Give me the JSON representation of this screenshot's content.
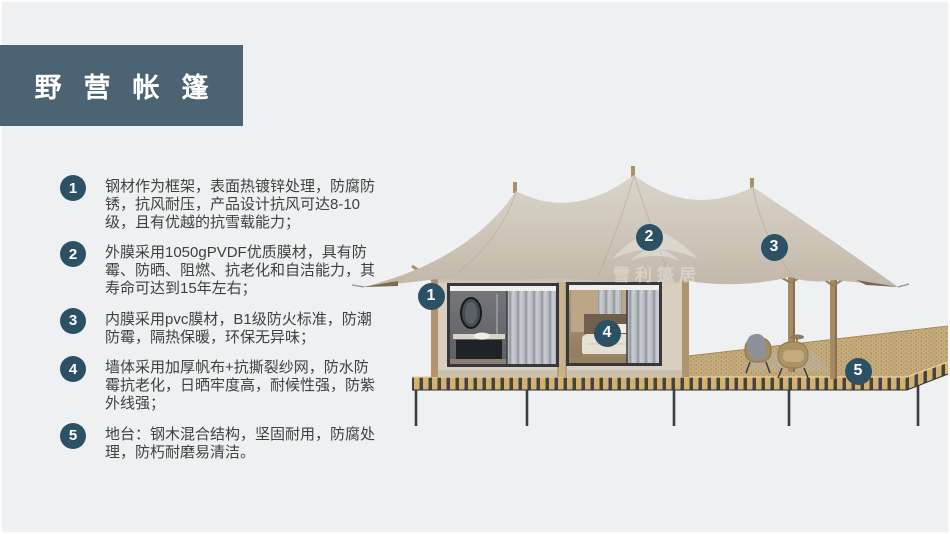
{
  "slide": {
    "title": "野营帐篷",
    "background_color": "#eff0f2",
    "banner_color": "#4c6374",
    "badge_color": "#2d5164",
    "body_text_color": "#3f4040"
  },
  "features": [
    {
      "num": "1",
      "text": "钢材作为框架，表面热镀锌处理，防腐防锈，抗风耐压，产品设计抗风可达8-10级，且有优越的抗雪载能力；"
    },
    {
      "num": "2",
      "text": "外膜采用1050gPVDF优质膜材，具有防霉、防晒、阻燃、抗老化和自洁能力，其寿命可达到15年左右；"
    },
    {
      "num": "3",
      "text": "内膜采用pvc膜材，B1级防火标准，防潮防霉，隔热保暖，环保无异味；"
    },
    {
      "num": "4",
      "text": "墙体采用加厚帆布+抗撕裂纱网，防水防霉抗老化，日晒牢度高，耐候性强，防紫外线强；"
    },
    {
      "num": "5",
      "text": "地台：钢木混合结构，坚固耐用，防腐处理，防朽耐磨易清洁。"
    }
  ],
  "illustration": {
    "watermark": {
      "icon": "tent-roof-icon",
      "text": "雪利篷居"
    },
    "callouts": [
      {
        "num": "1",
        "x": 431,
        "y": 296
      },
      {
        "num": "2",
        "x": 649,
        "y": 237
      },
      {
        "num": "3",
        "x": 774,
        "y": 247
      },
      {
        "num": "4",
        "x": 607,
        "y": 333
      },
      {
        "num": "5",
        "x": 858,
        "y": 371
      }
    ],
    "palette": {
      "canopy": "#ccc4b7",
      "wall": "#d9cec0",
      "wood": "#ab9068",
      "deck": "#c6ac7c",
      "deck_stripe_light": "#d2b173",
      "deck_stripe_dark": "#45443c",
      "legs": "#3a3f45"
    }
  }
}
